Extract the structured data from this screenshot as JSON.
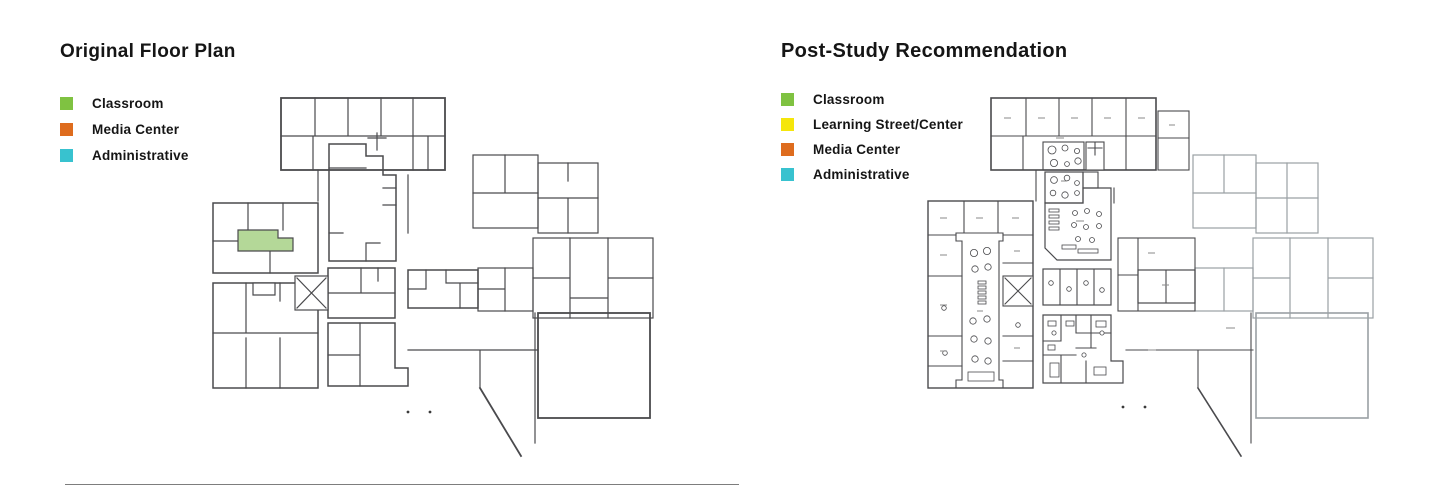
{
  "colors": {
    "classroom": "#7FC241",
    "classroom_light": "#B4D898",
    "media_center": "#DE6C1E",
    "media_center_light": "#E9A169",
    "administrative": "#38C2CF",
    "administrative_light": "#86D6DE",
    "learning_street": "#F5E60B",
    "wall_dark": "#4a4a4d",
    "wall_light": "#9aa0a4"
  },
  "left_panel": {
    "title": "Original Floor Plan",
    "legend": [
      {
        "label": "Classroom"
      },
      {
        "label": "Media Center"
      },
      {
        "label": "Administrative"
      }
    ]
  },
  "right_panel": {
    "title": "Post-Study Recommendation",
    "legend": [
      {
        "label": "Classroom"
      },
      {
        "label": "Learning Street/Center"
      },
      {
        "label": "Media Center"
      },
      {
        "label": "Administrative"
      }
    ]
  }
}
